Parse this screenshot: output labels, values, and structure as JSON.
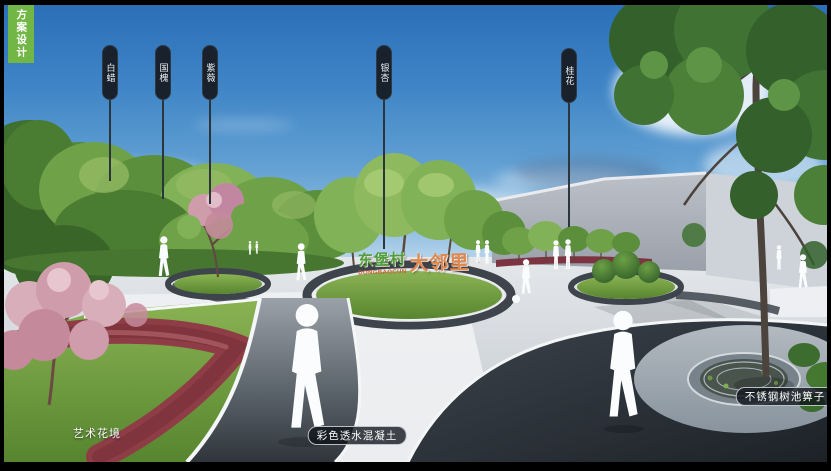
{
  "tab": {
    "label": "方案设计"
  },
  "tree_signs": {
    "items": [
      {
        "label": "白蜡"
      },
      {
        "label": "国槐"
      },
      {
        "label": "紫薇"
      },
      {
        "label": "银杏"
      },
      {
        "label": "桂花"
      }
    ]
  },
  "center_sign": {
    "village": "东堡村",
    "pinyin": "DONGBAOCUN",
    "suffix": "大邻里"
  },
  "annotations": {
    "flower_border": "艺术花境",
    "permeable_concrete": "彩色透水混凝土",
    "tree_grate": "不锈钢树池箅子"
  },
  "colors": {
    "tab_green": "#72b645",
    "sign_plate_navy": "#19222c",
    "village_name_green": "#4f9e3a",
    "sign_suffix_orange": "#e0884e",
    "flower_bed_red": "#8e3d47",
    "sky_blue": "#2b6fb8",
    "dark_path": "#272d34"
  }
}
